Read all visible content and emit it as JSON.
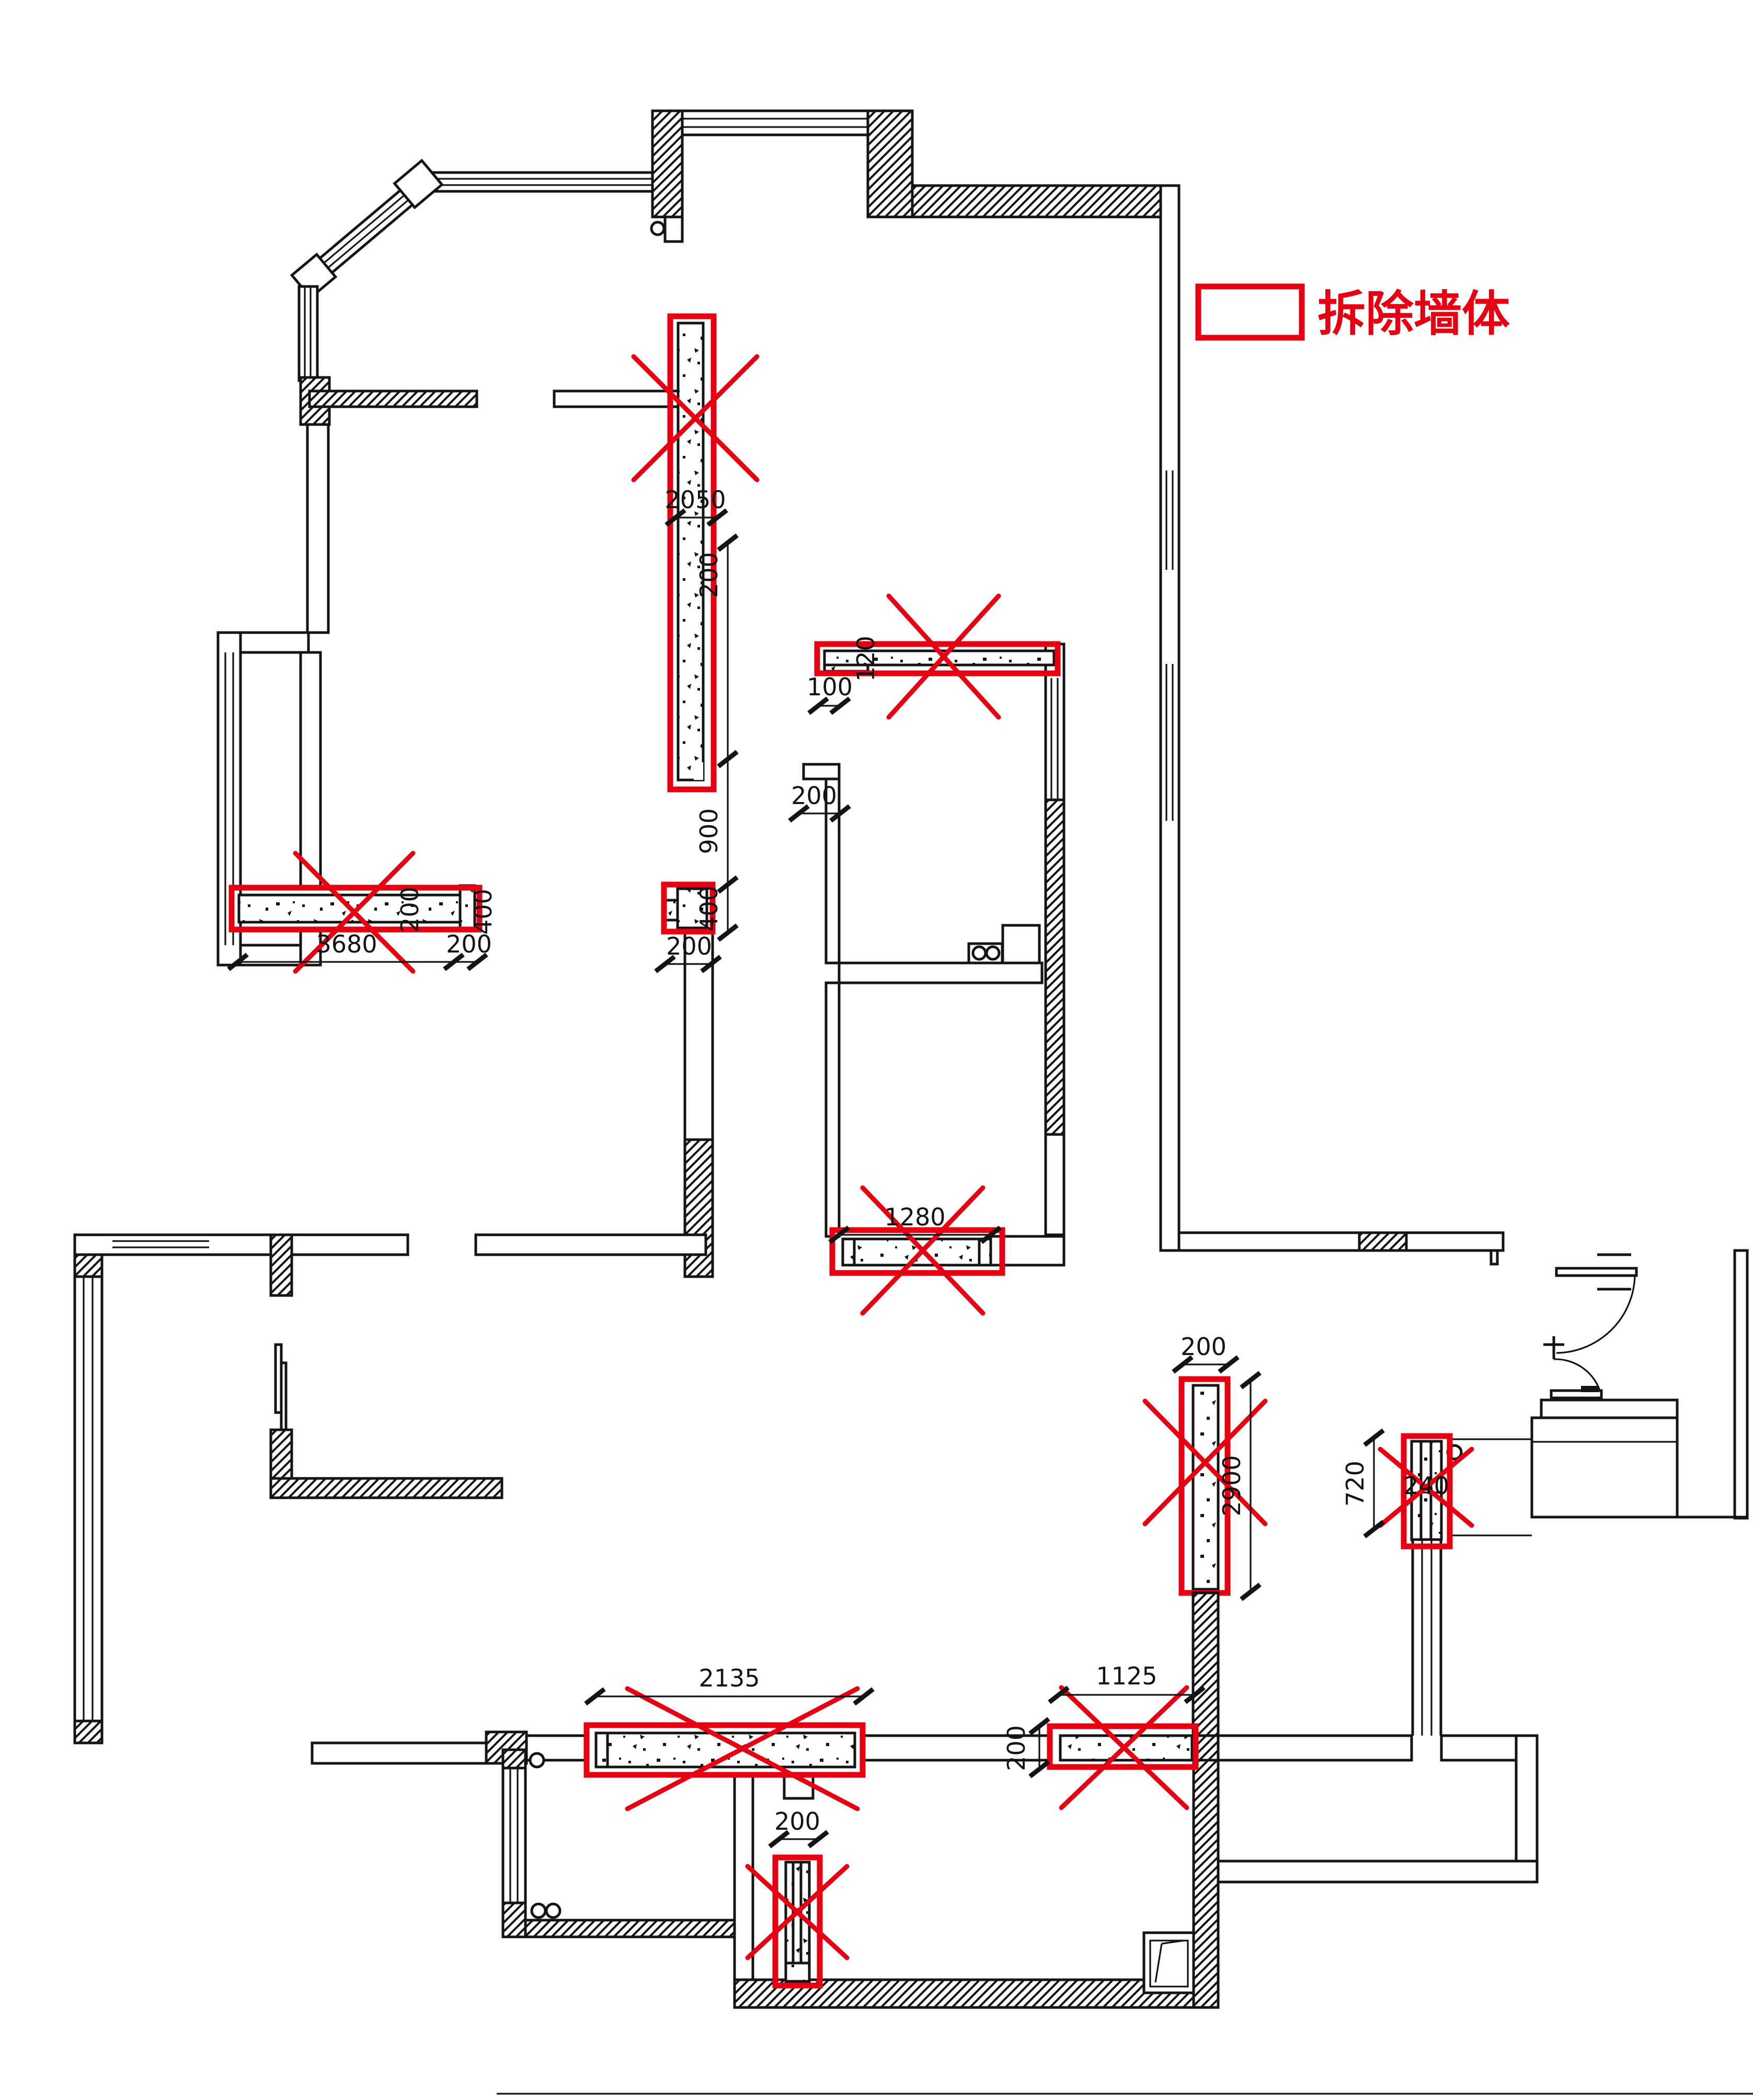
{
  "title": "demolition-plan",
  "legend": {
    "label": "拆除墙体",
    "swatch": "red-outline-rectangle"
  },
  "colors": {
    "demolish_red": "#e60012",
    "ink": "#141414",
    "paper": "#ffffff"
  },
  "dims": {
    "d2050": "2050",
    "d200_r1": "200",
    "d900": "900",
    "d400_chain": "400",
    "d3680": "3680",
    "d200_3680": "200",
    "d200_wall": "200",
    "d400_wall": "400",
    "d100": "100",
    "d120": "120",
    "d200_kitchen": "200",
    "d1280": "1280",
    "d200_junction": "200",
    "d200_r5": "200",
    "d2900": "2900",
    "d720": "720",
    "d240": "240",
    "d2135": "2135",
    "d200_r8": "200",
    "d1125": "1125",
    "d200_r6": "200"
  },
  "demolition_walls": [
    {
      "id": "upper-vertical-wall",
      "length": "2050",
      "thickness": "200"
    },
    {
      "id": "upper-thin-horizontal-wall",
      "length_note": "100",
      "thickness": "120"
    },
    {
      "id": "left-horizontal-wall",
      "length": "3680",
      "end_offset": "200",
      "thickness": "200",
      "end_height": "400"
    },
    {
      "id": "junction-block",
      "size": "200"
    },
    {
      "id": "corridor-wall",
      "length": "1280"
    },
    {
      "id": "right-vertical-wall",
      "length": "2900",
      "thickness": "200"
    },
    {
      "id": "entry-window-pier",
      "length": "720",
      "thickness": "240"
    },
    {
      "id": "bottom-left-wall",
      "length": "2135",
      "thickness": "200"
    },
    {
      "id": "bottom-middle-pier",
      "width": "200"
    },
    {
      "id": "bottom-right-wall",
      "length": "1125",
      "thickness": "200"
    }
  ]
}
